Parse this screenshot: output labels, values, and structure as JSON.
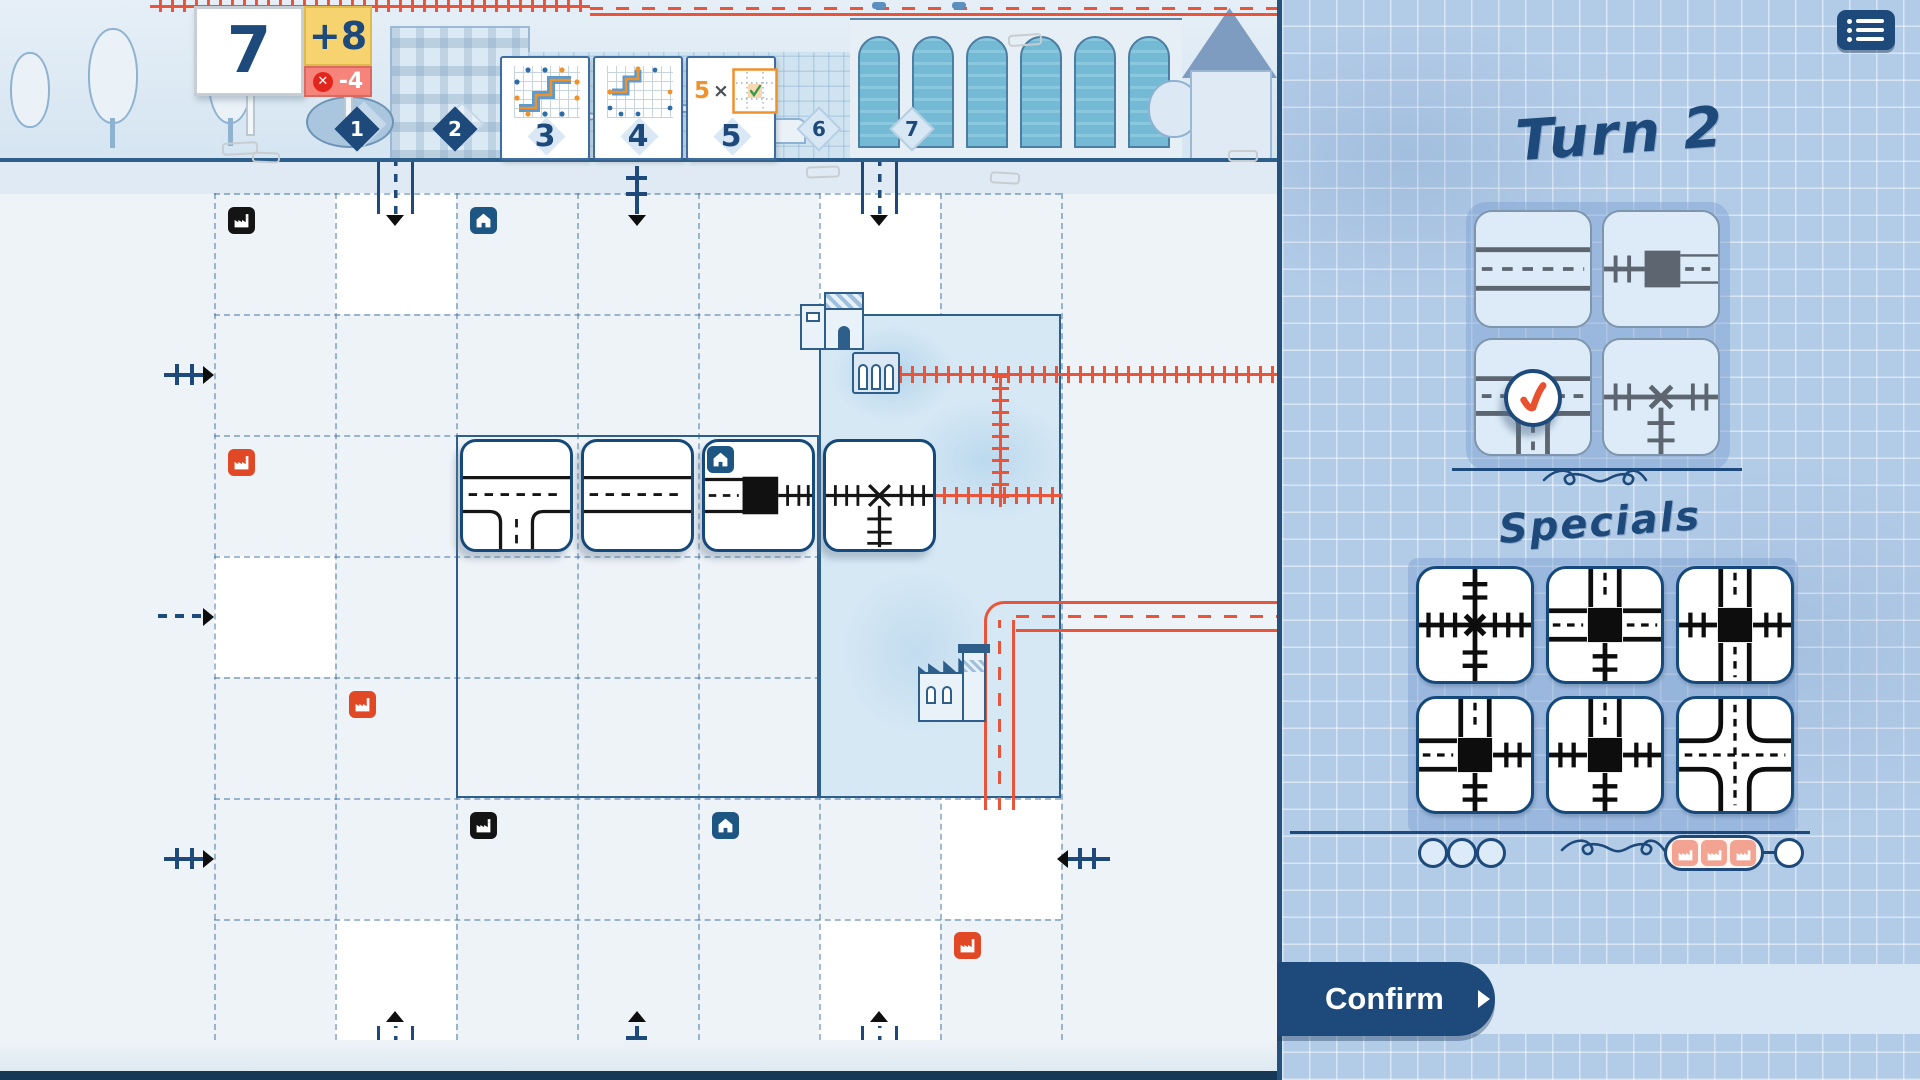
{
  "score": {
    "total": "7",
    "bonus": "+8",
    "penalty": "-4"
  },
  "round_track": {
    "completed": [
      "1",
      "2"
    ],
    "cards": [
      {
        "number": "3",
        "objective": "long-route-diagram"
      },
      {
        "number": "4",
        "objective": "short-route-diagram"
      },
      {
        "number": "5",
        "multiplier": "5",
        "times_symbol": "×",
        "objective": "checked-cell-diagram"
      }
    ],
    "upcoming": [
      "6",
      "7"
    ]
  },
  "panel": {
    "turn_title": "Turn 2",
    "specials_title": "Specials",
    "confirm_label": "Confirm",
    "dice": [
      {
        "name": "road-straight",
        "selected": false
      },
      {
        "name": "station-rail-road",
        "selected": false
      },
      {
        "name": "road-t-junction",
        "selected": true
      },
      {
        "name": "rail-t-crossing",
        "selected": false
      }
    ],
    "special_tiles": [
      "rail-crossroad-x",
      "road-through-rail-station",
      "rail-through-road-station",
      "road-rail-corner-station",
      "road-rail-t-station",
      "road-crossroad"
    ],
    "special_use_slots": 3,
    "factory_tokens": 3
  },
  "board": {
    "placed_tiles": [
      "road-t-junction",
      "road-straight",
      "station-road-rail",
      "rail-t-crossing"
    ],
    "icons": [
      "factory-black",
      "house-blue",
      "factory-red",
      "factory-red",
      "factory-black",
      "house-blue",
      "factory-red"
    ],
    "exits": {
      "top": [
        "road",
        "rail",
        "road"
      ],
      "left": [
        "rail",
        "road",
        "rail"
      ],
      "right": [
        "rail"
      ],
      "bottom": [
        "road",
        "rail",
        "road"
      ]
    }
  },
  "colors": {
    "navy": "#1d4a7a",
    "ink_red": "#e8553b",
    "yellow": "#f7d36f",
    "salmon": "#f6847b",
    "panel_blue": "#b2cbe7",
    "check_orange": "#e8502e"
  }
}
